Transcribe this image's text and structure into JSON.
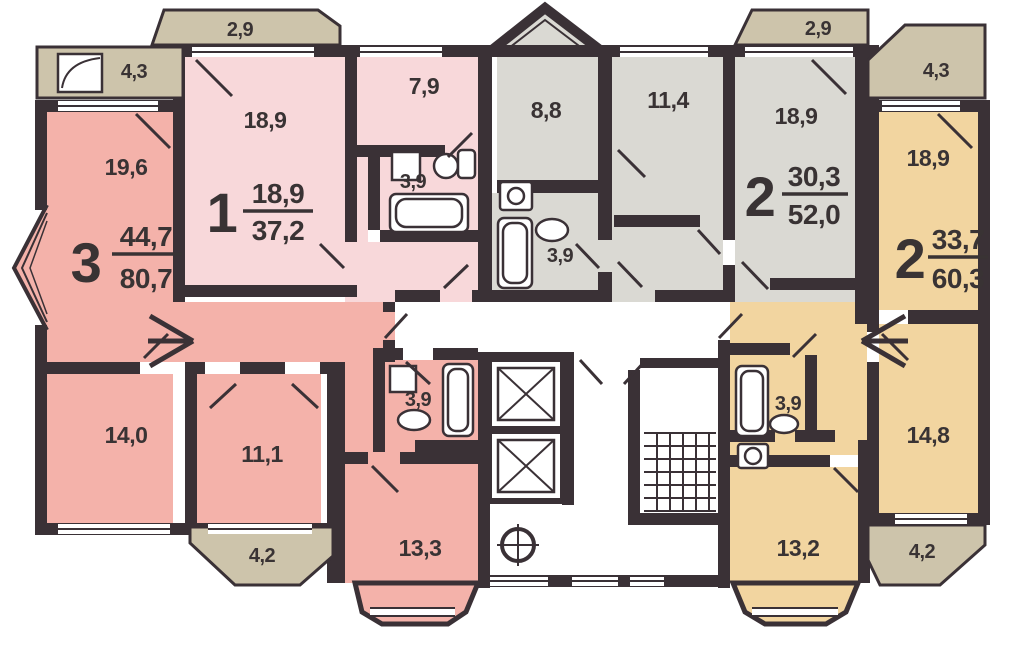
{
  "plan": {
    "apartments": {
      "apt_3_left": {
        "number": "3",
        "living_area": "44,7",
        "total_area": "80,7",
        "rooms": {
          "living1": "19,6",
          "living2": "14,0",
          "living3": "11,1",
          "kitchen": "13,3",
          "bathroom": "3,9"
        }
      },
      "apt_1": {
        "number": "1",
        "living_area": "18,9",
        "total_area": "37,2",
        "rooms": {
          "living": "18,9",
          "kitchen": "7,9",
          "bathroom": "3,9"
        }
      },
      "apt_2_gray": {
        "number": "2",
        "living_area": "30,3",
        "total_area": "52,0",
        "rooms": {
          "living1": "18,9",
          "living2": "11,4",
          "kitchen": "8,8",
          "bathroom": "3,9"
        }
      },
      "apt_2_tan": {
        "number": "2",
        "living_area": "33,7",
        "total_area": "60,3",
        "rooms": {
          "living1": "18,9",
          "living2": "14,8",
          "kitchen": "13,2",
          "bathroom": "3,9"
        }
      }
    },
    "balconies": {
      "top_left_loggia": "4,3",
      "top_left": "2,9",
      "top_right": "2,9",
      "top_right_loggia": "4,3",
      "bottom_left": "4,2",
      "bottom_right": "4,2"
    },
    "colors": {
      "apartment_3": "#f4b2aa",
      "apartment_1": "#f8d8da",
      "apartment_2_gray": "#dad9d3",
      "apartment_2_tan": "#f2d5a0",
      "balcony": "#cdc4ab",
      "walls": "#3a3136",
      "text": "#393334"
    }
  }
}
